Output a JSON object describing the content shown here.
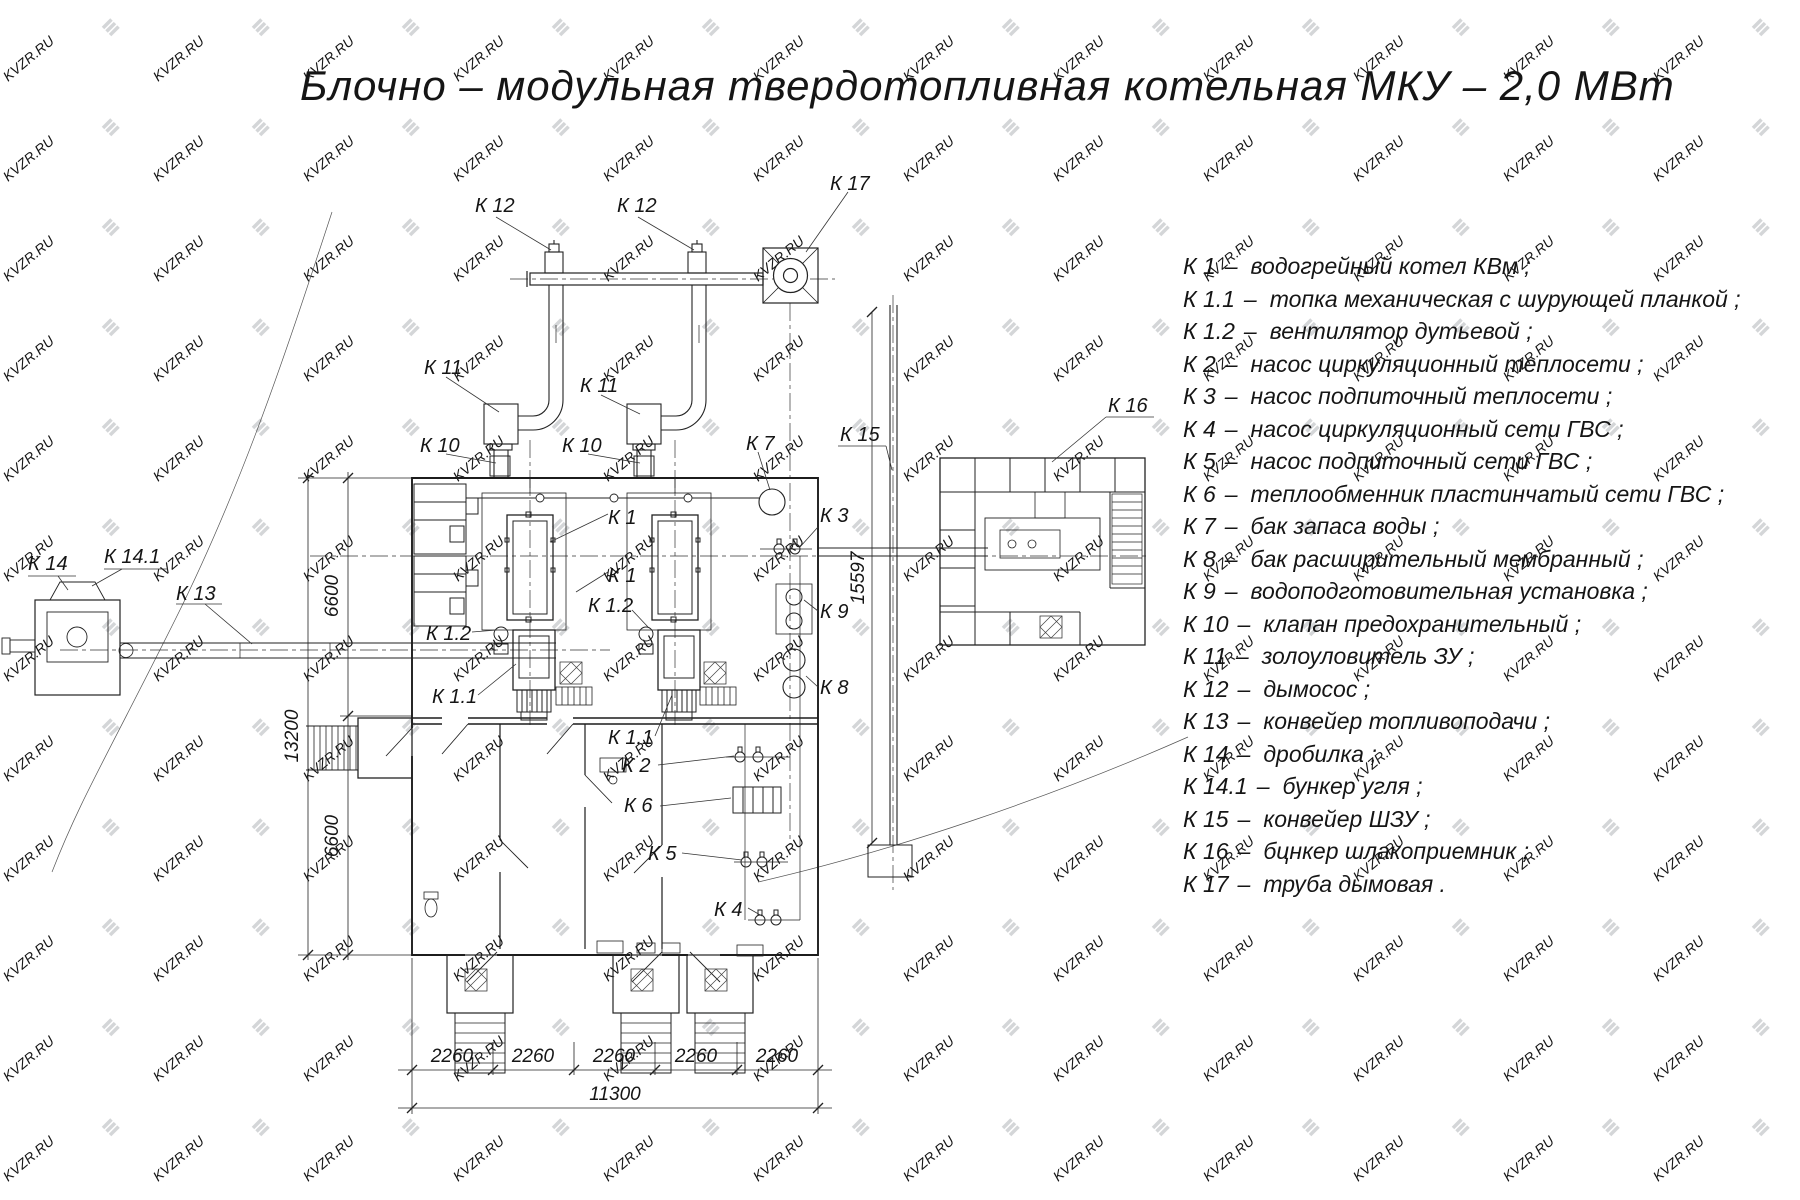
{
  "title": "Блочно – модульная твердотопливная котельная МКУ – 2,0  МВт",
  "watermark": {
    "text": "KVZR.RU"
  },
  "legend": {
    "items": [
      {
        "code": "К 1",
        "sep": "–",
        "desc": "водогрейный котел КВм ;"
      },
      {
        "code": "К 1.1",
        "sep": "–",
        "desc": "топка механическая с шурующей планкой ;"
      },
      {
        "code": "К 1.2",
        "sep": "–",
        "desc": "вентилятор дутьевой ;"
      },
      {
        "code": "К 2",
        "sep": "–",
        "desc": "насос циркуляционный теплосети ;"
      },
      {
        "code": "К 3",
        "sep": "–",
        "desc": "насос подпиточный теплосети ;"
      },
      {
        "code": "К 4",
        "sep": "–",
        "desc": "насос циркуляционный сети ГВС ;"
      },
      {
        "code": "К 5",
        "sep": "–",
        "desc": "насос подпиточный сети ГВС ;"
      },
      {
        "code": "К 6",
        "sep": "–",
        "desc": "теплообменник пластинчатый сети ГВС ;"
      },
      {
        "code": "К 7",
        "sep": "–",
        "desc": "бак запаса воды ;"
      },
      {
        "code": "К 8",
        "sep": "–",
        "desc": "бак расширительный мембранный ;"
      },
      {
        "code": "К 9",
        "sep": "–",
        "desc": "водоподготовительная установка ;"
      },
      {
        "code": "К 10",
        "sep": "–",
        "desc": "клапан предохранительный ;"
      },
      {
        "code": "К 11",
        "sep": "–",
        "desc": "золоуловитель ЗУ ;"
      },
      {
        "code": "К 12",
        "sep": "–",
        "desc": "дымосос ;"
      },
      {
        "code": "К 13",
        "sep": "–",
        "desc": "конвейер топливоподачи ;"
      },
      {
        "code": "К 14",
        "sep": "–",
        "desc": "дробилка ;"
      },
      {
        "code": "К 14.1",
        "sep": "–",
        "desc": "бункер угля ;"
      },
      {
        "code": "К 15",
        "sep": "–",
        "desc": "конвейер ШЗУ ;"
      },
      {
        "code": "К 16",
        "sep": "–",
        "desc": "бцнкер шлакоприемник ;"
      },
      {
        "code": "К 17",
        "sep": "–",
        "desc": "труба дымовая ."
      }
    ]
  },
  "plan": {
    "labels": {
      "k12_left": "К 12",
      "k12_right": "К 12",
      "k17": "К 17",
      "k11_left": "К 11",
      "k11_right": "К 11",
      "k10_left": "К 10",
      "k10_right": "К 10",
      "k7": "К 7",
      "k15": "К 15",
      "k16": "К 16",
      "k1_top": "К 1",
      "k1_bottom": "К 1",
      "k1_2_left": "К 1.2",
      "k1_2_right": "К 1.2",
      "k1_1_left": "К 1.1",
      "k1_1_right": "К 1.1",
      "k2": "К 2",
      "k3": "К 3",
      "k4": "К 4",
      "k5": "К 5",
      "k6": "К 6",
      "k8": "К 8",
      "k9": "К 9",
      "k13": "К 13",
      "k14": "К 14",
      "k14_1": "К 14.1"
    },
    "dimensions": {
      "left_top": "6600",
      "left_overall": "13200",
      "left_bottom": "6600",
      "conveyor_height": "15597",
      "bottom_segments": [
        "2260",
        "2260",
        "2260",
        "2260",
        "2260"
      ],
      "bottom_total": "11300"
    }
  }
}
